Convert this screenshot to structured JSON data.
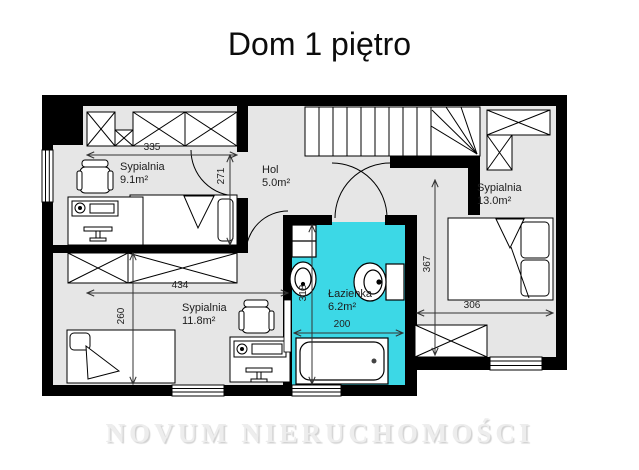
{
  "title": "Dom 1 piętro",
  "watermark": "NOVUM NIERUCHOMOŚCI",
  "rooms": [
    {
      "id": "bedroom-top-left",
      "name": "Sypialnia",
      "area": "9.1m²"
    },
    {
      "id": "hall",
      "name": "Hol",
      "area": "5.0m²"
    },
    {
      "id": "bedroom-right",
      "name": "Sypialnia",
      "area": "13.0m²"
    },
    {
      "id": "bedroom-bottom-left",
      "name": "Sypialnia",
      "area": "11.8m²"
    },
    {
      "id": "bathroom",
      "name": "Łazienka",
      "area": "6.2m²"
    }
  ],
  "dimensions_cm": {
    "bedroom_top_left_width": "335",
    "bedroom_top_left_height": "271",
    "bedroom_bottom_left_width": "434",
    "bedroom_bottom_left_height": "260",
    "bathroom_height": "318",
    "bathroom_width": "200",
    "bedroom_right_height": "367",
    "bedroom_right_width": "306"
  },
  "colors": {
    "bathroom_fill": "#3cd8e6",
    "floor_fill": "#e6e6e6",
    "wall": "#000000"
  }
}
